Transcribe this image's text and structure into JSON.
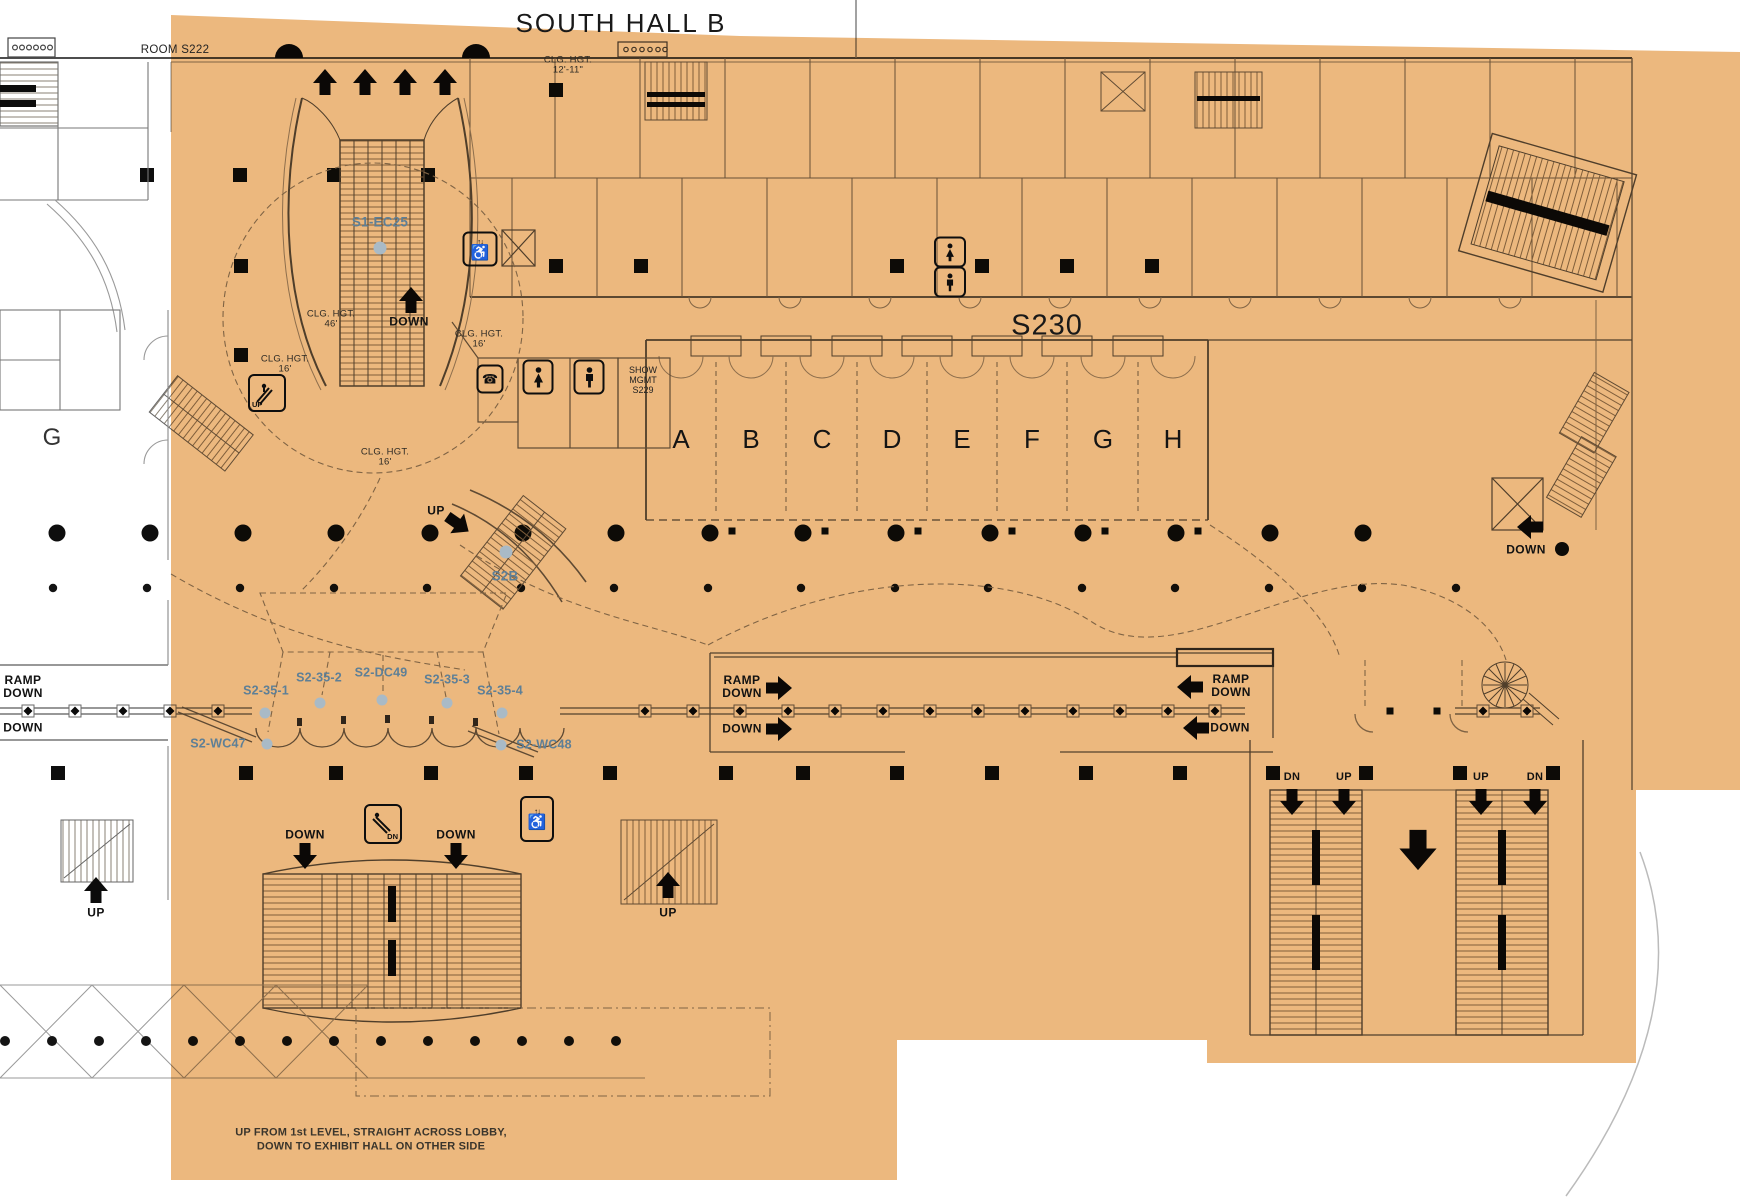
{
  "title": "SOUTH HALL B",
  "colors": {
    "overlay": "#ecb87e",
    "blue": "#5e7f96",
    "ink": "#1c1c1c"
  },
  "rooms": {
    "s222": "ROOM S222",
    "s230": "S230",
    "s229": {
      "l1": "SHOW",
      "l2": "MGMT",
      "l3": "S229"
    },
    "g": "G",
    "hall_sections": [
      "A",
      "B",
      "C",
      "D",
      "E",
      "F",
      "G",
      "H"
    ]
  },
  "ceiling": {
    "c12": {
      "l1": "CLG. HGT.",
      "l2": "12'-11\""
    },
    "c46": {
      "l1": "CLG. HGT.",
      "l2": "46'"
    },
    "c16a": {
      "l1": "CLG. HGT.",
      "l2": "16'"
    },
    "c16b": {
      "l1": "CLG. HGT.",
      "l2": "16'"
    },
    "c16c": {
      "l1": "CLG. HGT.",
      "l2": "16'"
    }
  },
  "zones": {
    "s1_ec25": "S1-EC25",
    "s2b": "S2B",
    "row": [
      "S2-35-1",
      "S2-35-2",
      "S2-DC49",
      "S2-35-3",
      "S2-35-4"
    ],
    "wc47": "S2-WC47",
    "wc48": "S2-WC48"
  },
  "nav": {
    "ramp_down_left": {
      "l1": "RAMP",
      "l2": "DOWN"
    },
    "down_left": "DOWN",
    "ramp_down_center": {
      "l1": "RAMP",
      "l2": "DOWN"
    },
    "down_center": "DOWN",
    "ramp_down_right": {
      "l1": "RAMP",
      "l2": "DOWN"
    },
    "down_right": "DOWN",
    "down_upper": "DOWN",
    "up_to_s2b": "UP",
    "down_stair_left": "DOWN",
    "down_stair_right": "DOWN",
    "up_stair_bottom_left": "UP",
    "up_stair_bottom_center": "UP",
    "down_right_mid": "DOWN",
    "stair_pair_left": {
      "l1": "DN",
      "l2": "UP"
    },
    "stair_pair_right": {
      "l1": "UP",
      "l2": "DN"
    }
  },
  "icons": {
    "escalator_up_label": "UP",
    "escalator_down_label": "DN",
    "wheelchair_glyph": "♿",
    "elevator_arrows_glyph": "↑↓",
    "phone_glyph": "☎"
  },
  "note": {
    "l1": "UP FROM 1st LEVEL, STRAIGHT ACROSS LOBBY,",
    "l2": "DOWN TO EXHIBIT HALL ON OTHER SIDE"
  }
}
